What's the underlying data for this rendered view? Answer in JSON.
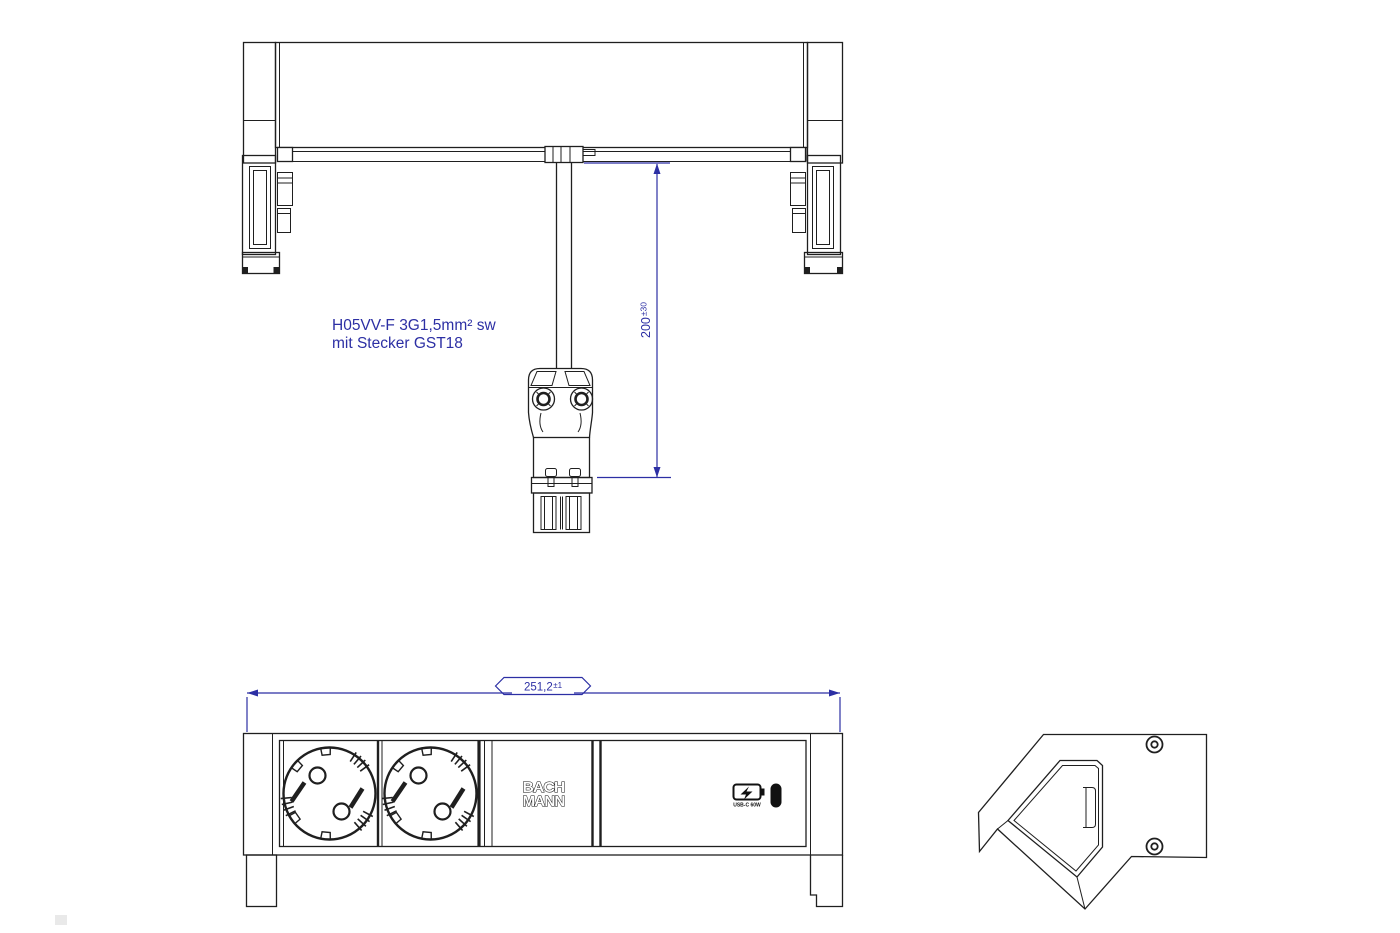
{
  "colors": {
    "background": "#ffffff",
    "line": "#1f1f1f",
    "accent_blue": "#2c2fa4"
  },
  "cable_annotation": {
    "line1": "H05VV-F 3G1,5mm² sw",
    "line2": "mit Stecker GST18"
  },
  "dimensions": {
    "cable_length": {
      "value": "200",
      "tolerance": "±30"
    },
    "overall_width": {
      "value": "251,2",
      "tolerance": "±1"
    }
  },
  "front_view": {
    "logo_line1": "BACH",
    "logo_line2": "MANN",
    "usb_label": "USB-C 60W"
  }
}
